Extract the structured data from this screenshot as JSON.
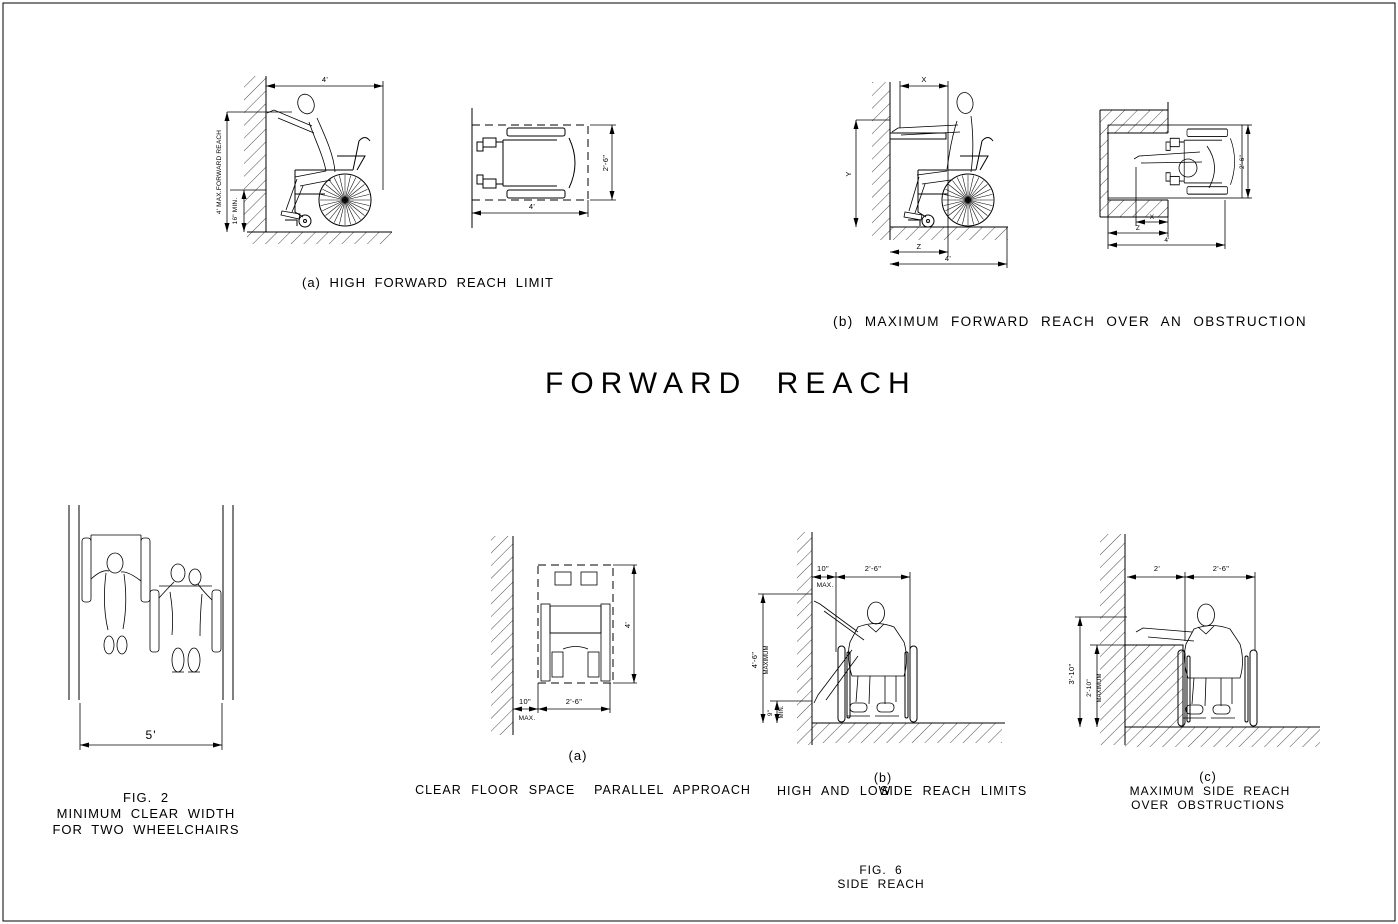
{
  "colors": {
    "background": "#ffffff",
    "line": "#000000"
  },
  "title": "FORWARD REACH",
  "fig4a": {
    "caption": "(a) HIGH FORWARD REACH LIMIT",
    "side": {
      "dim_width_top": "4'",
      "dim_reach": "4' MAX.FORWARD REACH",
      "dim_toe_clearance": "16\" MIN."
    },
    "plan": {
      "dim_depth": "2'-6\"",
      "dim_length": "4'"
    }
  },
  "fig5b": {
    "caption": "(b) MAXIMUM FORWARD REACH OVER AN OBSTRUCTION",
    "side": {
      "dim_x": "X",
      "dim_y": "Y",
      "dim_z": "Z",
      "dim_length": "4'"
    },
    "plan": {
      "dim_x": "X",
      "dim_z": "Z",
      "dim_length": "4'",
      "dim_width": "2'-6\""
    }
  },
  "fig2": {
    "dim_width": "5'",
    "caption": [
      "FIG. 2",
      "MINIMUM CLEAR WIDTH",
      "FOR TWO WHEELCHAIRS"
    ]
  },
  "fig6": {
    "a": {
      "label": "(a)",
      "caption": "CLEAR FLOOR SPACE  PARALLEL APPROACH",
      "dim_wall_offset": "10\"",
      "dim_wall_offset_note": "MAX.",
      "dim_width": "2'-6\"",
      "dim_length": "4'"
    },
    "b": {
      "label": "(b)",
      "caption_left": "HIGH AND LOW",
      "caption_right": "SIDE REACH LIMITS",
      "dim_wall_offset": "10\"",
      "dim_wall_offset_note": "MAX.",
      "dim_width": "2'-6\"",
      "dim_high_reach": "4'-6\"",
      "dim_high_reach_note": "MAXIMUM",
      "dim_low_reach": "9\"",
      "dim_low_reach_note": "MIN."
    },
    "c": {
      "label": "(c)",
      "caption": [
        "MAXIMUM SIDE REACH",
        "OVER OBSTRUCTIONS"
      ],
      "dim_obstruction_depth": "2'",
      "dim_width": "2'-6\"",
      "dim_max_reach": "3'-10\"",
      "dim_obstruction_height": "2'-10\"",
      "dim_obstruction_height_note": "MAXIMUM"
    },
    "caption": [
      "FIG. 6",
      "SIDE REACH"
    ]
  }
}
